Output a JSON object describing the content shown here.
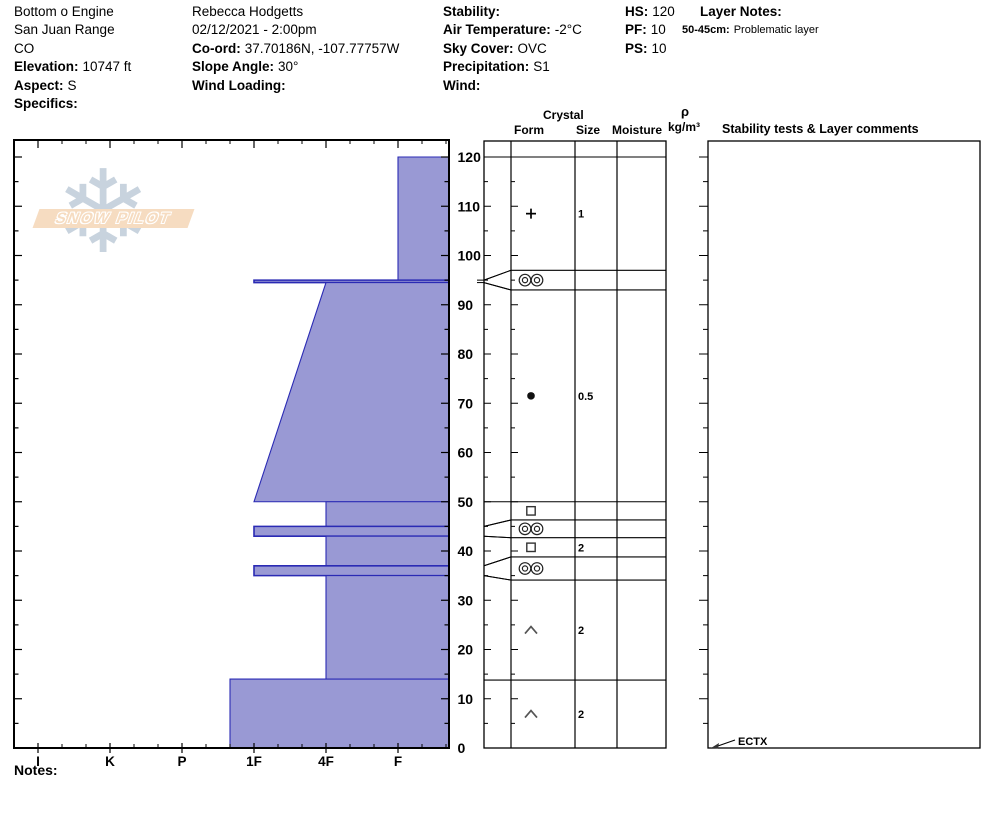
{
  "header": {
    "col1": {
      "lines": [
        {
          "label": "",
          "value": "Bottom o Engine"
        },
        {
          "label": "",
          "value": "San Juan Range"
        },
        {
          "label": "",
          "value": "CO"
        },
        {
          "label": "Elevation:",
          "value": "10747 ft"
        },
        {
          "label": "Aspect:",
          "value": "S"
        },
        {
          "label": "Specifics:",
          "value": ""
        }
      ]
    },
    "col2": {
      "lines": [
        {
          "label": "",
          "value": "Rebecca Hodgetts"
        },
        {
          "label": "",
          "value": "02/12/2021 - 2:00pm"
        },
        {
          "label": "Co-ord:",
          "value": "37.70186N, -107.77757W"
        },
        {
          "label": "Slope Angle:",
          "value": "30°"
        },
        {
          "label": "Wind Loading:",
          "value": ""
        }
      ]
    },
    "col3": {
      "lines": [
        {
          "label": "Stability:",
          "value": ""
        },
        {
          "label": "Air Temperature:",
          "value": "-2°C"
        },
        {
          "label": "Sky Cover:",
          "value": "OVC"
        },
        {
          "label": "Precipitation:",
          "value": "S1"
        },
        {
          "label": "Wind:",
          "value": ""
        }
      ]
    },
    "col4": {
      "lines": [
        {
          "label": "HS:",
          "value": "120"
        },
        {
          "label": "PF:",
          "value": "10"
        },
        {
          "label": "PS:",
          "value": "10"
        }
      ]
    },
    "layer_notes": {
      "title": "Layer Notes:",
      "note_label": "50-45cm:",
      "note_value": "Problematic layer"
    }
  },
  "logo": {
    "text": "SNOW PILOT",
    "snowflake_glyph": "❄"
  },
  "column_headers": {
    "crystal": "Crystal",
    "form": "Form",
    "size": "Size",
    "moisture": "Moisture",
    "rho": "ρ",
    "rho_units": "kg/m³",
    "stability": "Stability tests & Layer comments"
  },
  "notes_label": "Notes:",
  "colors": {
    "layer_fill": "#9999d4",
    "layer_outline": "#2a2ab4",
    "axis": "#000000",
    "grid": "#1a1a1a"
  },
  "chart_data": {
    "type": "area",
    "title": "Snow pit hardness profile with grain form, grain size and stability test columns",
    "xlabel": "Hand hardness",
    "ylabel": "Depth (cm)",
    "hardness_categories": [
      "I",
      "K",
      "P",
      "1F",
      "4F",
      "F"
    ],
    "depth_ticks_labeled": [
      0,
      10,
      20,
      30,
      40,
      50,
      60,
      70,
      80,
      90,
      100,
      110,
      120
    ],
    "depth_minor_step_cm": 5,
    "total_depth_hs_cm": 120,
    "layers": [
      {
        "top_cm": 120,
        "bottom_cm": 95,
        "hardness": "F",
        "grain_form": "precipitation particles (+)",
        "grain_size_mm": "1"
      },
      {
        "top_cm": 95,
        "bottom_cm": 94.5,
        "hardness": "1F",
        "crust": true,
        "grain_form": "melt-freeze crust (◎◎)",
        "grain_size_mm": ""
      },
      {
        "top_cm": 94.5,
        "bottom_cm": 50,
        "hardness_top": "4F",
        "hardness_bottom": "1F",
        "grain_form": "rounded grains (●)",
        "grain_size_mm": "0.5"
      },
      {
        "top_cm": 50,
        "bottom_cm": 45,
        "hardness": "4F",
        "grain_form": "faceted crystals (□)",
        "grain_size_mm": ""
      },
      {
        "top_cm": 45,
        "bottom_cm": 43,
        "hardness": "1F",
        "crust": true,
        "grain_form": "melt-freeze crust (◎◎)",
        "grain_size_mm": ""
      },
      {
        "top_cm": 43,
        "bottom_cm": 37,
        "hardness": "4F",
        "grain_form": "faceted crystals (□)",
        "grain_size_mm": "2"
      },
      {
        "top_cm": 37,
        "bottom_cm": 35,
        "hardness": "1F",
        "crust": true,
        "grain_form": "melt-freeze crust (◎◎)",
        "grain_size_mm": ""
      },
      {
        "top_cm": 35,
        "bottom_cm": 14,
        "hardness": "4F",
        "grain_form": "depth hoar (∧)",
        "grain_size_mm": "2"
      },
      {
        "top_cm": 14,
        "bottom_cm": 0,
        "hardness": "1F+",
        "grain_form": "depth hoar (∧)",
        "grain_size_mm": "2"
      }
    ],
    "table_rows": [
      {
        "row_top": 120,
        "row_bottom": 97,
        "symbol": "plus",
        "size": "1",
        "moisture": ""
      },
      {
        "row_top": 97,
        "row_bottom": 93,
        "symbol": "crust",
        "size": "",
        "moisture": ""
      },
      {
        "row_top": 93,
        "row_bottom": 50,
        "symbol": "dot",
        "size": "0.5",
        "moisture": ""
      },
      {
        "row_top": 50,
        "row_bottom": 46.3,
        "symbol": "square",
        "size": "",
        "moisture": ""
      },
      {
        "row_top": 46.3,
        "row_bottom": 42.7,
        "symbol": "crust",
        "size": "",
        "moisture": ""
      },
      {
        "row_top": 42.7,
        "row_bottom": 38.8,
        "symbol": "square",
        "size": "2",
        "moisture": ""
      },
      {
        "row_top": 38.8,
        "row_bottom": 34.1,
        "symbol": "crust",
        "size": "",
        "moisture": ""
      },
      {
        "row_top": 34.1,
        "row_bottom": 13.8,
        "symbol": "chevron",
        "size": "2",
        "moisture": ""
      },
      {
        "row_top": 13.8,
        "row_bottom": 0,
        "symbol": "chevron",
        "size": "2",
        "moisture": ""
      }
    ],
    "stability_tests": [
      {
        "label": "ECTX",
        "depth_cm": 0
      }
    ],
    "density_values": [],
    "legend_position": "none",
    "grid": false
  }
}
